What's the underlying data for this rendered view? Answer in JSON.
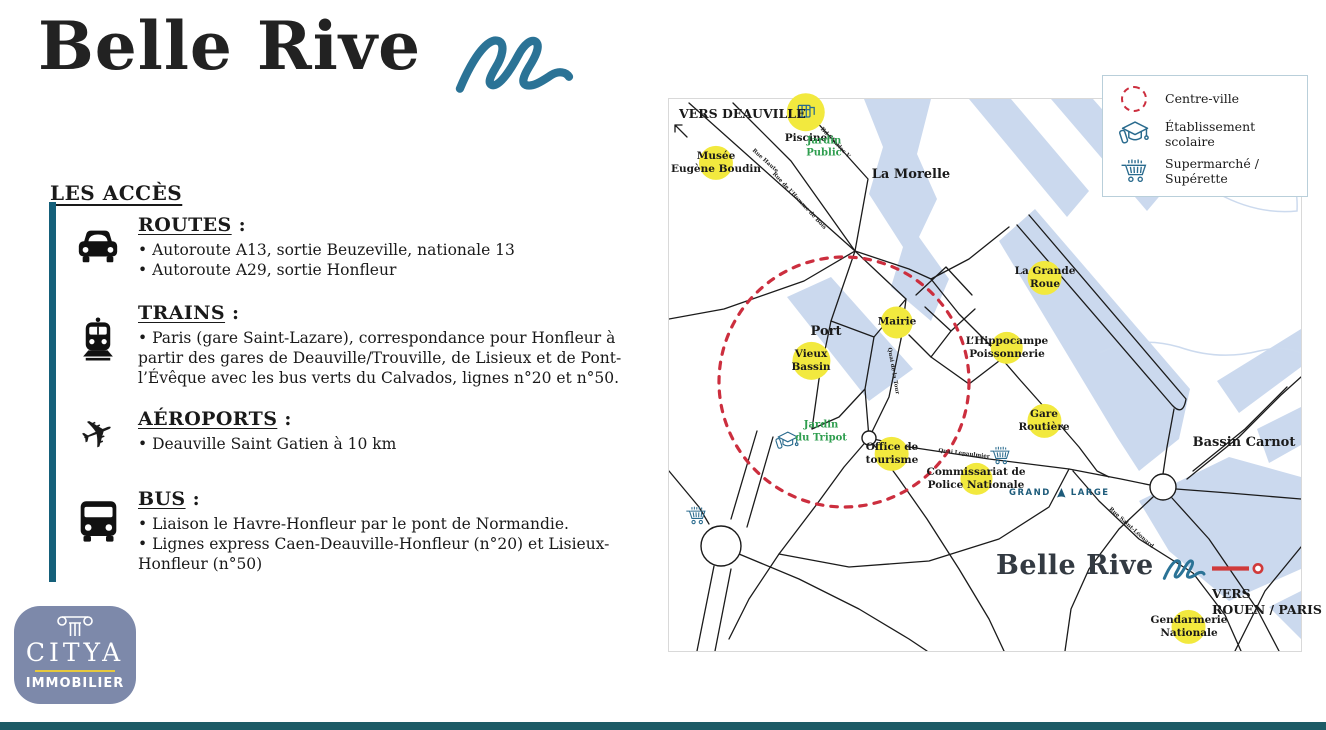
{
  "brand": {
    "name": "Belle Rive"
  },
  "left_panel": {
    "heading": "LES ACCÈS",
    "title_suffix": " :",
    "sections": [
      {
        "icon": "car-icon",
        "title": "ROUTES",
        "bullets": [
          "Autoroute A13, sortie Beuzeville, nationale 13",
          "Autoroute A29, sortie Honfleur"
        ]
      },
      {
        "icon": "train-icon",
        "title": "TRAINS",
        "bullets": [
          "Paris (gare Saint-Lazare), correspondance pour Honfleur à partir des gares de Deauville/Trouville, de Lisieux et de Pont-l’Évêque avec les bus verts du Calvados, lignes n°20 et n°50."
        ]
      },
      {
        "icon": "plane-icon",
        "title": "AÉROPORTS",
        "bullets": [
          "Deauville Saint Gatien à 10 km"
        ]
      },
      {
        "icon": "bus-icon",
        "title": "BUS",
        "bullets": [
          "Liaison le Havre-Honfleur par le pont de Normandie.",
          "Lignes express Caen-Deauville-Honfleur (n°20) et Lisieux-Honfleur (n°50)"
        ]
      }
    ]
  },
  "agency_logo": {
    "name": "CITYA",
    "subtitle": "IMMOBILIER"
  },
  "map": {
    "brand": {
      "name": "Belle Rive"
    },
    "grand_large": {
      "word1": "GRAND",
      "word2": "LARGE"
    },
    "legend": [
      {
        "icon": "centre-ville-icon",
        "label": "Centre-ville"
      },
      {
        "icon": "school-icon",
        "label": "Établissement scolaire"
      },
      {
        "icon": "supermarket-icon",
        "label": "Supermarché / Supérette"
      }
    ],
    "directions": [
      {
        "id": "deauville",
        "x": 10,
        "y": 7,
        "lines": [
          "VERS DEAUVILLE"
        ]
      },
      {
        "id": "rouen-paris",
        "x": 543,
        "y": 487,
        "lines": [
          "VERS",
          "ROUEN / PARIS"
        ]
      }
    ],
    "pois": [
      {
        "type": "yellow",
        "icon": "pool-icon",
        "below": true,
        "x": 137,
        "y": 14,
        "r": 19,
        "lines": [
          "Piscine"
        ]
      },
      {
        "type": "green",
        "x": 155,
        "y": 49,
        "lines": [
          "Jardin",
          "Public"
        ]
      },
      {
        "type": "yellow",
        "x": 47,
        "y": 64,
        "r": 17,
        "lines": [
          "Musée",
          "Eugène Boudin"
        ]
      },
      {
        "type": "plain",
        "x": 242,
        "y": 76,
        "lines": [
          "La Morelle"
        ]
      },
      {
        "type": "yellow",
        "x": 376,
        "y": 179,
        "r": 17,
        "lines": [
          "La Grande",
          "Roue"
        ]
      },
      {
        "type": "yellow",
        "x": 228,
        "y": 223,
        "r": 16,
        "lines": [
          "Mairie"
        ]
      },
      {
        "type": "plain",
        "x": 157,
        "y": 233,
        "lines": [
          "Port"
        ]
      },
      {
        "type": "yellow",
        "x": 142,
        "y": 262,
        "r": 19,
        "lines": [
          "Vieux",
          "Bassin"
        ]
      },
      {
        "type": "yellow",
        "x": 338,
        "y": 249,
        "r": 16,
        "lines": [
          "L’Hippocampe",
          "Poissonnerie"
        ]
      },
      {
        "type": "yellow",
        "x": 375,
        "y": 322,
        "r": 17,
        "lines": [
          "Gare",
          "Routière"
        ]
      },
      {
        "type": "plain",
        "x": 575,
        "y": 344,
        "lines": [
          "Bassin Carnot"
        ]
      },
      {
        "type": "green",
        "x": 152,
        "y": 333,
        "lines": [
          "Jardin",
          "du Tripot"
        ]
      },
      {
        "type": "yellow",
        "x": 223,
        "y": 355,
        "r": 17,
        "lines": [
          "Office de",
          "tourisme"
        ]
      },
      {
        "type": "yellow",
        "x": 307,
        "y": 380,
        "r": 16,
        "lines": [
          "Commissariat de",
          "Police Nationale"
        ]
      },
      {
        "type": "yellow",
        "x": 520,
        "y": 528,
        "r": 17,
        "lines": [
          "Gendarmerie",
          "Nationale"
        ]
      }
    ],
    "street_labels": [
      {
        "text": "Rue Haute",
        "x": 96,
        "y": 62,
        "rotate": 42
      },
      {
        "text": "Rue de l’Homme de Bois",
        "x": 130,
        "y": 102,
        "rotate": 47
      },
      {
        "text": "Bd Charles V",
        "x": 166,
        "y": 44,
        "rotate": 46
      },
      {
        "text": "Quai de la Tour",
        "x": 224,
        "y": 272,
        "rotate": 80
      },
      {
        "text": "Quai Lepaulmier",
        "x": 295,
        "y": 355,
        "rotate": 7
      },
      {
        "text": "Rue Saint-Léonard",
        "x": 462,
        "y": 429,
        "rotate": 42
      }
    ],
    "icons": [
      {
        "icon": "school-icon",
        "x": 118,
        "y": 342
      },
      {
        "icon": "supermarket-icon",
        "x": 27,
        "y": 417
      },
      {
        "icon": "supermarket-icon",
        "x": 331,
        "y": 357
      }
    ]
  },
  "colors": {
    "accent_teal": "#15607a",
    "footer_teal": "#1d5b66",
    "wave_teal": "#2b7396",
    "poi_yellow": "#f2e93e",
    "water_blue": "#cbd9ee",
    "centre_ville_red": "#cc2e3e",
    "garden_green": "#2f9e4f",
    "citya_blue": "#7d89aa",
    "citya_gold": "#e7c93c",
    "grand_large_blue": "#1d5b7a"
  }
}
